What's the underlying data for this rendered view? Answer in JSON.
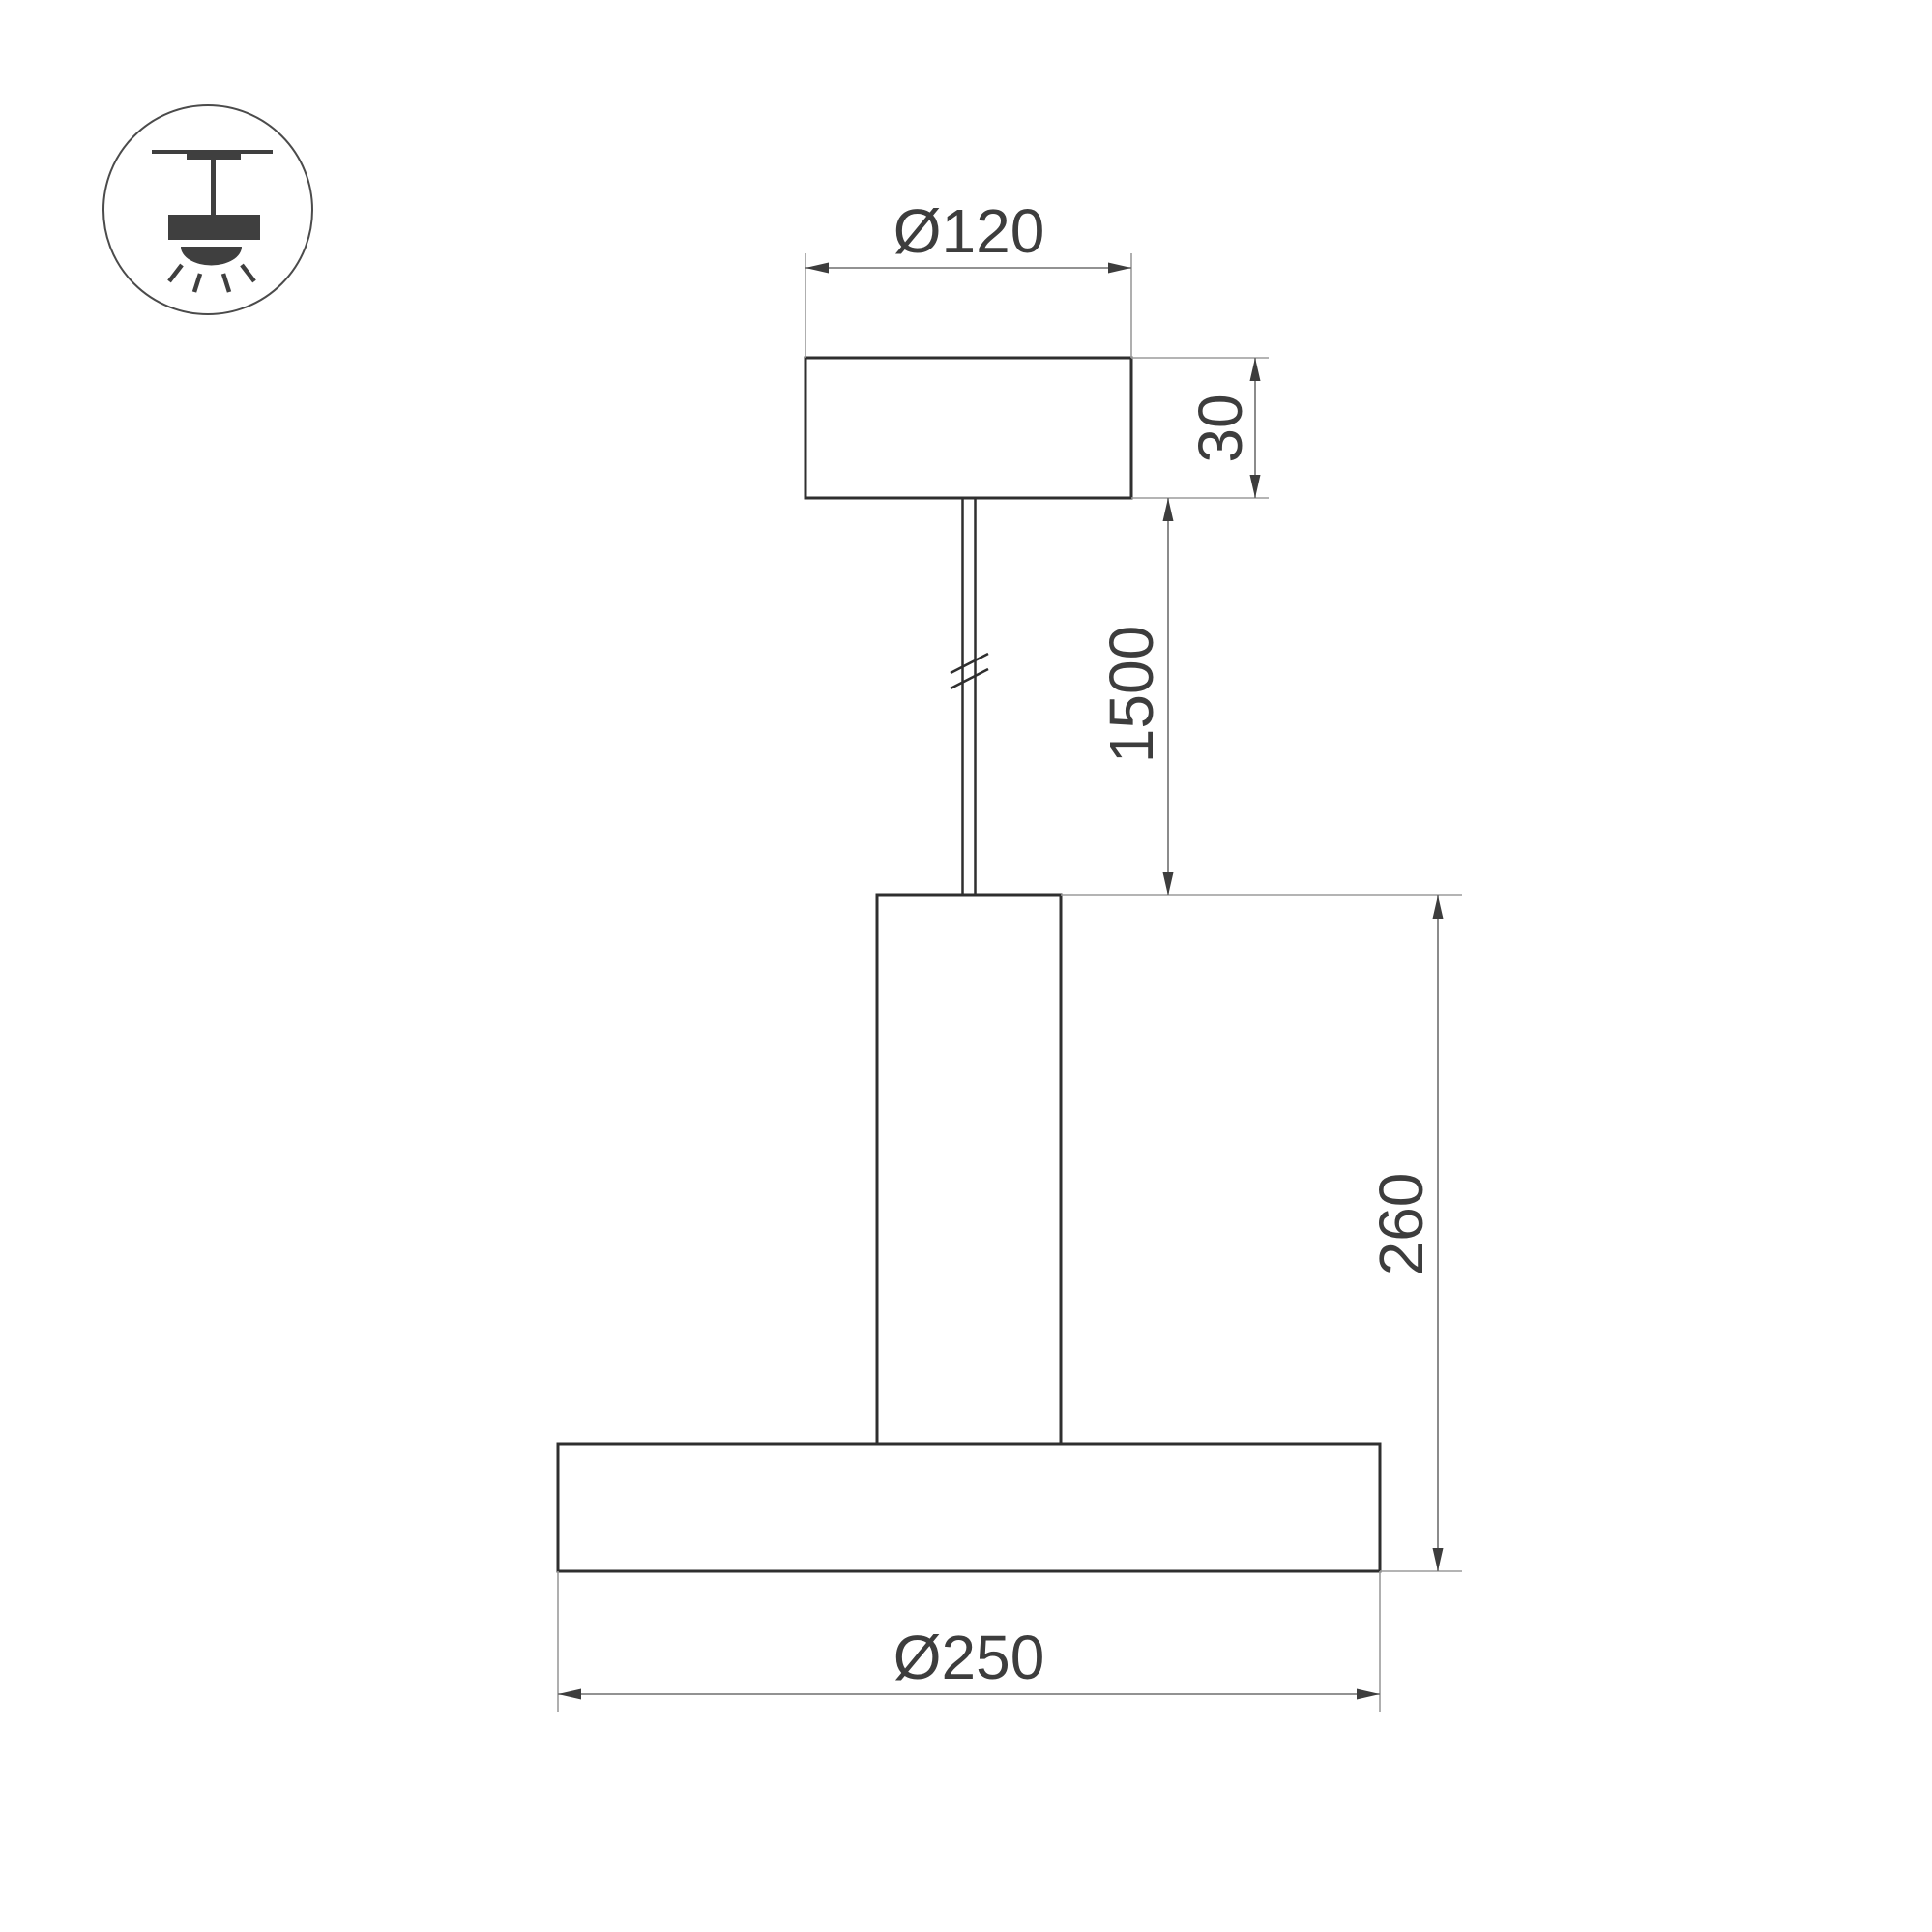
{
  "drawing": {
    "background": "#ffffff",
    "dimensions": {
      "canopy_diameter": "Ø120",
      "canopy_height": "30",
      "suspension_length": "1500",
      "fixture_height": "260",
      "shade_diameter": "Ø250"
    },
    "icons": {
      "mount_type": "ceiling-pendant-luminaire-icon"
    },
    "colors": {
      "shape_outline": "#2f2f2f",
      "dimension_line": "#6e6e6e",
      "extension_line": "#9b9b9b",
      "dimension_text": "#3d3d3d",
      "icon_fill": "#3f3f3f"
    }
  }
}
